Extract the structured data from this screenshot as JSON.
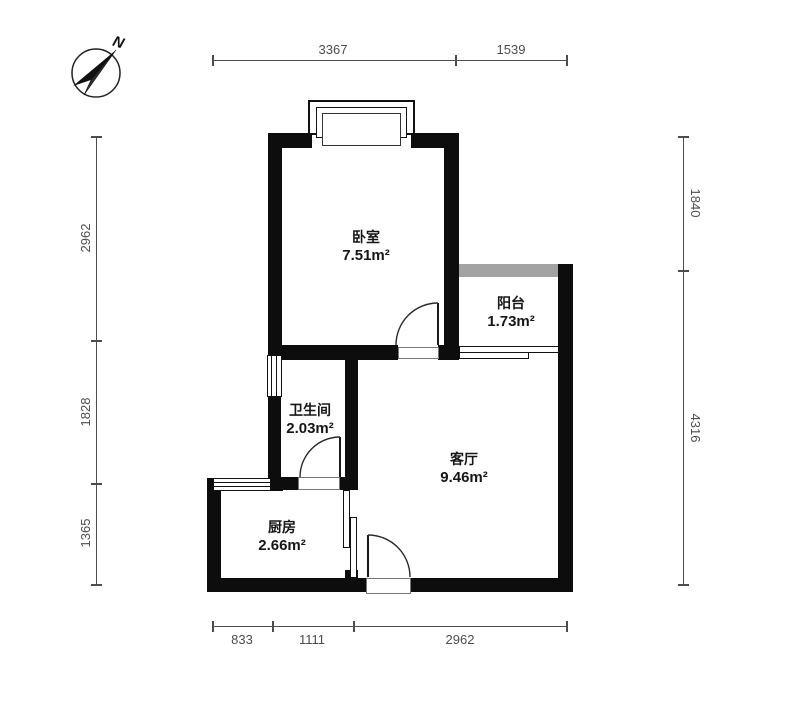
{
  "compass": {
    "label": "N"
  },
  "rooms": [
    {
      "id": "bedroom",
      "name": "卧室",
      "area": "7.51m²"
    },
    {
      "id": "balcony",
      "name": "阳台",
      "area": "1.73m²"
    },
    {
      "id": "bathroom",
      "name": "卫生间",
      "area": "2.03m²"
    },
    {
      "id": "living",
      "name": "客厅",
      "area": "9.46m²"
    },
    {
      "id": "kitchen",
      "name": "厨房",
      "area": "2.66m²"
    }
  ],
  "dimensions": {
    "top": [
      "3367",
      "1539"
    ],
    "bottom": [
      "833",
      "1111",
      "2962"
    ],
    "left": [
      "2962",
      "1828",
      "1365"
    ],
    "right": [
      "1840",
      "4316"
    ]
  },
  "colors": {
    "wall": "#0d0d0d",
    "balcony_open_edge": "#a3a3a3",
    "dimension_line": "#4d4d4d",
    "background": "#ffffff"
  }
}
